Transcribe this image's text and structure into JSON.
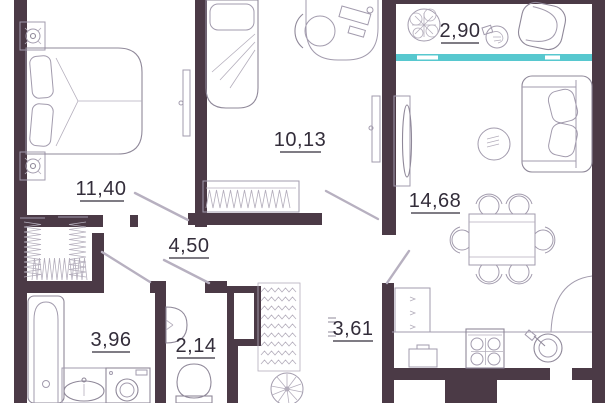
{
  "plan": {
    "type": "apartment-floor-plan",
    "units": "m2",
    "colors": {
      "wall": "#4b3a46",
      "furniture_line": "#a29bad",
      "label_text": "#332d3a",
      "balcony_glazing": "#57c8cf",
      "background": "#ffffff"
    },
    "rooms": [
      {
        "name": "bedroom",
        "area": "11,40",
        "furniture": [
          "double-bed",
          "nightstand-lamp",
          "nightstand-lamp",
          "radiator"
        ]
      },
      {
        "name": "bedroom-2",
        "area": "10,13",
        "furniture": [
          "single-bed",
          "wardrobe",
          "desk",
          "desk-chair",
          "radiator"
        ]
      },
      {
        "name": "balcony",
        "area": "2,90",
        "furniture": [
          "plant",
          "armchair",
          "planter-pot"
        ]
      },
      {
        "name": "living-kitchen",
        "area": "14,68",
        "furniture": [
          "sofa",
          "coffee-table",
          "tv-stand",
          "dining-table",
          "dining-chairs-x6",
          "kitchen-counter",
          "stove",
          "kitchen-sink",
          "drawer-unit",
          "base-cabinet"
        ]
      },
      {
        "name": "hallway",
        "area": "4,50",
        "furniture": [
          "built-in-closet-hangers"
        ]
      },
      {
        "name": "bathroom",
        "area": "3,96",
        "furniture": [
          "bathtub",
          "washbasin",
          "washing-machine"
        ]
      },
      {
        "name": "wc",
        "area": "2,14",
        "furniture": [
          "toilet",
          "corner-sink"
        ]
      },
      {
        "name": "corridor",
        "area": "3,61",
        "furniture": [
          "wardrobe-hangers",
          "ventilation-shaft",
          "fan"
        ]
      }
    ]
  }
}
